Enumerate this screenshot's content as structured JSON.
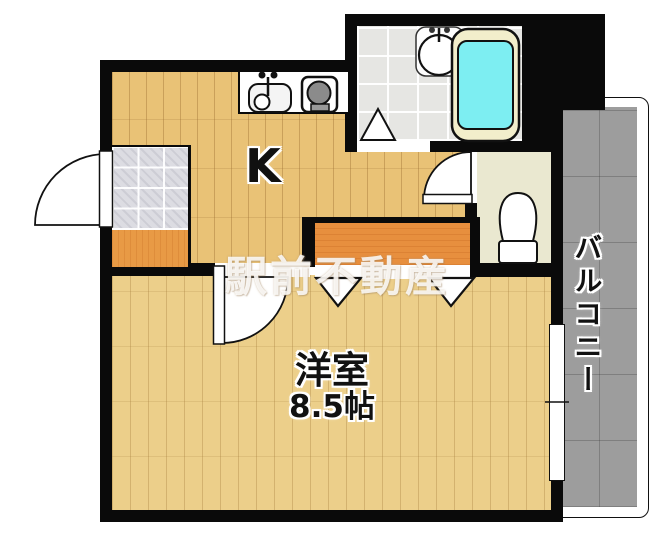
{
  "plan": {
    "type": "apartment-floor-plan",
    "rooms": {
      "kitchen": {
        "label": "K"
      },
      "main_room": {
        "label": "洋室",
        "size": "8.5帖"
      },
      "balcony": {
        "label": "バルコニー"
      },
      "bathroom": {
        "fixtures": [
          "bathtub",
          "washbasin"
        ]
      },
      "toilet": {
        "fixtures": [
          "toilet"
        ]
      },
      "entrance": {
        "fixtures": [
          "genkan-tile",
          "step"
        ]
      }
    },
    "fixtures": [
      "kitchen-sink",
      "gas-stove",
      "washbasin",
      "bathtub",
      "toilet",
      "entrance-door",
      "room-door",
      "toilet-door",
      "closet-folding-doors",
      "balcony-window"
    ],
    "watermark": "駅前不動産",
    "colors": {
      "wall": "#0a0a0a",
      "kitchen_floor": "#e9c276",
      "room_floor": "#eccf8a",
      "genkan_tile": "#dcdce2",
      "genkan_step": "#e89a45",
      "closet_floor": "#e78f3e",
      "toilet_floor": "#eae8d0",
      "bath_tile": "#e6e6e3",
      "bathtub_water": "#7deef2",
      "bathtub_rim": "#f2eecb",
      "balcony_tile": "#9d9d9d"
    }
  }
}
